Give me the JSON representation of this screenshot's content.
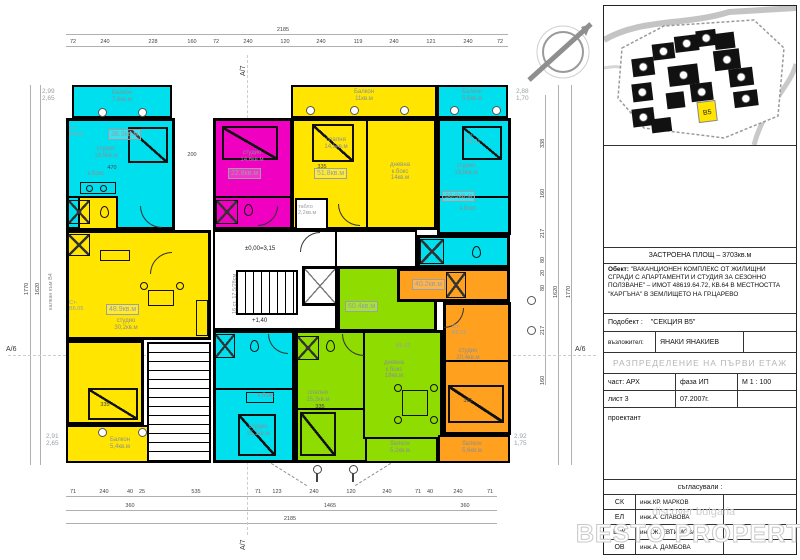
{
  "titleblock": {
    "built_area": "ЗАСТРОЕНА ПЛОЩ  –  3703кв.м",
    "object_label": "Обект:",
    "object_text": "\"ВАКАНЦИОНЕН КОМПЛЕКС ОТ ЖИЛИЩНИ СГРАДИ С АПАРТАМЕНТИ И СТУДИЯ ЗА СЕЗОННО ПОЛЗВАНЕ\" – ИМОТ 48619.64.72, КВ.64 В МЕСТНОСТТА \"КАРГЪНА\" В ЗЕМЛИЩЕТО НА ГР.ЦАРЕВО",
    "subobject_label": "Подобект :",
    "subobject_value": "\"СЕКЦИЯ В5\"",
    "client_label": "възложител:",
    "client_value": "ЯНАКИ ЯНАКИЕВ",
    "drawing_title": "РАЗПРЕДЕЛЕНИЕ НА ПЪРВИ ЕТАЖ",
    "part": "част: АРХ",
    "phase": "фаза ИП",
    "scale": "М 1 : 100",
    "sheet": "лист 3",
    "date": "07.2007г.",
    "designer_label": "проектант",
    "approvals_label": "съгласували :",
    "approvals": [
      {
        "code": "СК",
        "name": "инж.КР. МАРКОВ"
      },
      {
        "code": "ЕЛ",
        "name": "инж.А. СЛАВОВА"
      },
      {
        "code": "ВиК",
        "name": "инж.Ж. ЕВТИМОВА"
      },
      {
        "code": "ОВ",
        "name": "инж.А. ДАМБОВА"
      }
    ],
    "site_highlight_label": "В5"
  },
  "watermark": {
    "brand": "BESTO PROPERTIES",
    "sub": "discover bulgaria"
  },
  "plan": {
    "colors": {
      "cyan": "#00dfee",
      "yellow": "#ffe500",
      "magenta": "#f000c0",
      "green": "#8fdc00",
      "orange": "#ffa01e"
    },
    "apartments": {
      "tl": {
        "id": "Ст-\nВ5.06",
        "area": "38.3кв.м",
        "room": "студио\n18,9кв.м",
        "kitchen": "к.бокс",
        "balcony": "Балкон\n7,8кв.м"
      },
      "left": {
        "id": "Ст-\nВ5.05",
        "area": "48.9кв.м",
        "room": "студио\n30,2кв.м",
        "balcony": "Балкон\n5,4кв.м"
      },
      "magenta": {
        "area": "22.8кв.м",
        "room": "студио\n14,6кв.м"
      },
      "center": {
        "area": "51.8кв.м",
        "bedroom": "спалня\n14,5кв.м",
        "living": "дневна\nк.бокс\n14кв.м",
        "balcony": "Балкон\n11кв.м"
      },
      "tr": {
        "id": "Ст-\nВ5.01",
        "area": "36.9кв.м",
        "room": "студио\n19,8кв.м",
        "kitchen": "к.бокс",
        "balcony": "Балкон\n5,6кв.м"
      },
      "green": {
        "id": "В5.03",
        "area": "60.4кв.м",
        "bedroom": "спалня\n15,2кв.м",
        "living": "дневна\nк.бокс\n18кв.м",
        "balcony": "балкон\n5,2кв.м"
      },
      "orange": {
        "id": "Ст-\nВ5.02",
        "area": "40.2кв.м",
        "room": "студио\n20,4кв.м",
        "balcony": "балкон\n5,6кв.м"
      },
      "bottom": {
        "room": "студио\n15,1кв.м",
        "kitchen": "к.бокс"
      }
    },
    "core": {
      "level_zero": "±0,00=3,15",
      "level_mid": "+1,40",
      "stair_note": "16 ст. 17,5/28см",
      "panel_room": "табло\n2,2кв.м"
    },
    "dims": {
      "top": [
        "72",
        "240",
        "228",
        "160",
        "72",
        "240",
        "120",
        "240",
        "119",
        "240",
        "121",
        "240",
        "72"
      ],
      "top_total": "2185",
      "bottom": [
        "71",
        "240",
        "40",
        "25",
        "535",
        "71",
        "123",
        "240",
        "120",
        "240",
        "71",
        "40",
        "240",
        "71"
      ],
      "bottom_totals": [
        "360",
        "1465",
        "360"
      ],
      "bottom_overall": "2185",
      "left": [
        "1770",
        "1620"
      ],
      "right": [
        "338",
        "160",
        "217",
        "80",
        "20",
        "80",
        "217",
        "160"
      ],
      "right_totals": [
        "1620",
        "1770"
      ],
      "inner": [
        "470",
        "335",
        "335",
        "335",
        "335",
        "200"
      ]
    },
    "levels": {
      "tl": "2,99\n2,65",
      "bl": "2,91\n2,65",
      "tr": "2,88\n1,70",
      "br": "2,92\n1,75"
    },
    "axes": {
      "a7": "А/7",
      "a6": "А/6",
      "b4": "калкан към В4"
    }
  }
}
